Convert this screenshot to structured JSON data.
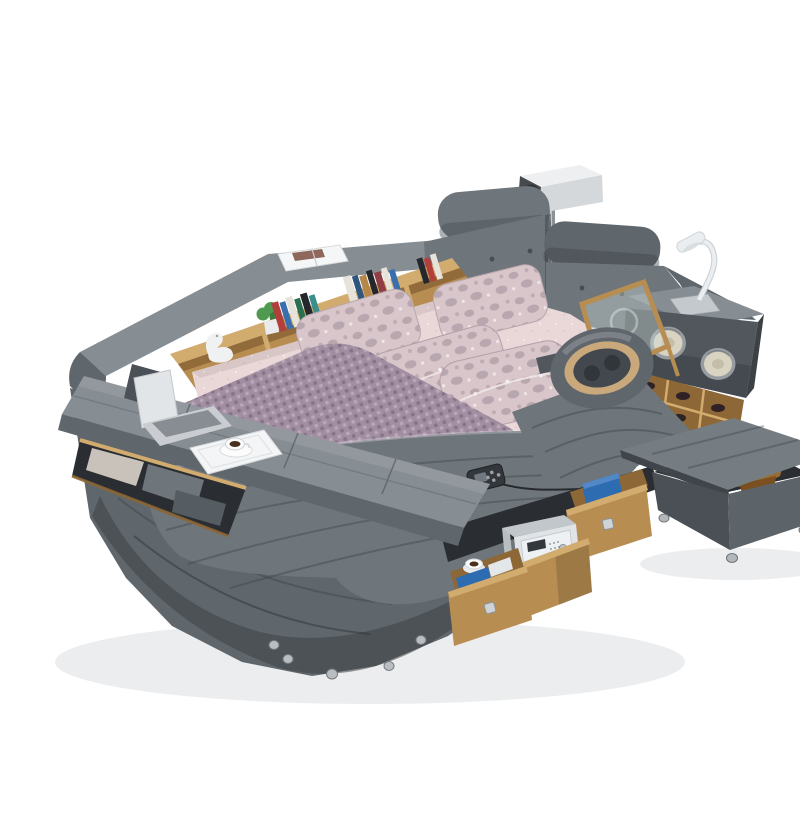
{
  "meta": {
    "alt": "Product photo on white background: gray leather multifunctional smart tatami bed with overhead projector, tufted headboard with headrest rolls, built-in bookshelf with books plant and swan ornament, padded storage bench with laptop and coffee tray, pink floral pillows and purple quilted runner, neck massage cushion on recliner pad, side panel with two round speakers and white gooseneck reading lamp, glass panel, wine cubby with bottles, pulled-out wooden storage drawers with safe box, and a lift-top storage ottoman with brown blanket"
  },
  "palette": {
    "background": "#ffffff",
    "floor_shadow": "#ecedee",
    "leather_light": "#868d93",
    "leather_mid": "#6e757b",
    "leather_mid2": "#5f666c",
    "leather_dark": "#51575d",
    "leather_deep": "#3c4146",
    "interior_dark": "#2a2e32",
    "wood": "#b78d52",
    "wood_dark": "#8d6736",
    "wood_light": "#d2ab6f",
    "sheet_pink": "#ead7d8",
    "pillow_base": "#d9c6ca",
    "pillow_pattern": "#b4a1aa",
    "runner_purple": "#a18ea1",
    "runner_dot_light": "#b9a7b8",
    "runner_dot_dark": "#877389",
    "speaker_rim": "#979ca0",
    "speaker_cone": "#d9d3c2",
    "lamp_white": "#ebeef0",
    "metal": "#c4c9cd",
    "projector_top": "#edeff1",
    "projector_side": "#d4d8db",
    "projector_front": "#454a4f",
    "lens_blue": "#55c7e9",
    "safe_body": "#e0e4e7",
    "safe_top": "#c2c7cb",
    "ottoman_light": "#757c82",
    "ottoman_mid": "#5c6369",
    "ottoman_dark": "#4a5056",
    "blanket_brown": "#9c6b31",
    "blanket_brown_dark": "#7a5020",
    "massage_tan": "#c9a87c",
    "massage_inner": "#43484e",
    "plant_green": "#4f9a50",
    "swan_white": "#eff1f2",
    "tray_white": "#f4f5f6",
    "cup_white": "#fbfbfc",
    "coffee": "#4a2f1c",
    "laptop_body": "#e2e5e7",
    "laptop_base": "#c9cdd1",
    "laptop_keys": "#878d92",
    "remote_dark": "#33373c",
    "denim_blue": "#2e6cb2",
    "book_red": "#b23f3a",
    "book_blue": "#3a6fae",
    "book_green": "#2b6f4f",
    "book_teal": "#3a8f8a",
    "book_white": "#e7e3da",
    "book_black": "#24282c",
    "book_tan": "#b5884a",
    "book_navy": "#30557f",
    "book_maroon": "#8f3f44"
  },
  "scene": {
    "objects": [
      {
        "id": "projector",
        "label": "ceiling projector on pole mount"
      },
      {
        "id": "headboard",
        "label": "tufted leather headboard with two headrest rolls"
      },
      {
        "id": "bookshelf",
        "label": "built-in wooden bookshelf with books"
      },
      {
        "id": "plant",
        "label": "small green plant"
      },
      {
        "id": "swan-ornament",
        "label": "white swan ornament"
      },
      {
        "id": "magazine",
        "label": "open magazine on rail"
      },
      {
        "id": "storage-bench",
        "label": "lift-top padded storage bench"
      },
      {
        "id": "laptop",
        "label": "open laptop on swivel stand"
      },
      {
        "id": "breakfast-tray",
        "label": "white tray with coffee cup"
      },
      {
        "id": "pillows",
        "label": "four pink floral pillows"
      },
      {
        "id": "quilted-runner",
        "label": "purple quilted bed runner"
      },
      {
        "id": "massage-pillow",
        "label": "neck massage cushion"
      },
      {
        "id": "speaker-panel",
        "label": "side panel with two round speakers"
      },
      {
        "id": "reading-lamp",
        "label": "white gooseneck reading lamp"
      },
      {
        "id": "glass-panel",
        "label": "wood-framed glass panel"
      },
      {
        "id": "wine-cubby",
        "label": "wooden cubby with bottles"
      },
      {
        "id": "remote-control",
        "label": "wired remote control"
      },
      {
        "id": "drawers",
        "label": "pulled-out wooden storage drawers"
      },
      {
        "id": "safe-box",
        "label": "small white safe box"
      },
      {
        "id": "storage-ottoman",
        "label": "lift-top storage ottoman with brown blanket"
      },
      {
        "id": "bed-base",
        "label": "gray leather bed base on metal ball feet"
      }
    ]
  }
}
